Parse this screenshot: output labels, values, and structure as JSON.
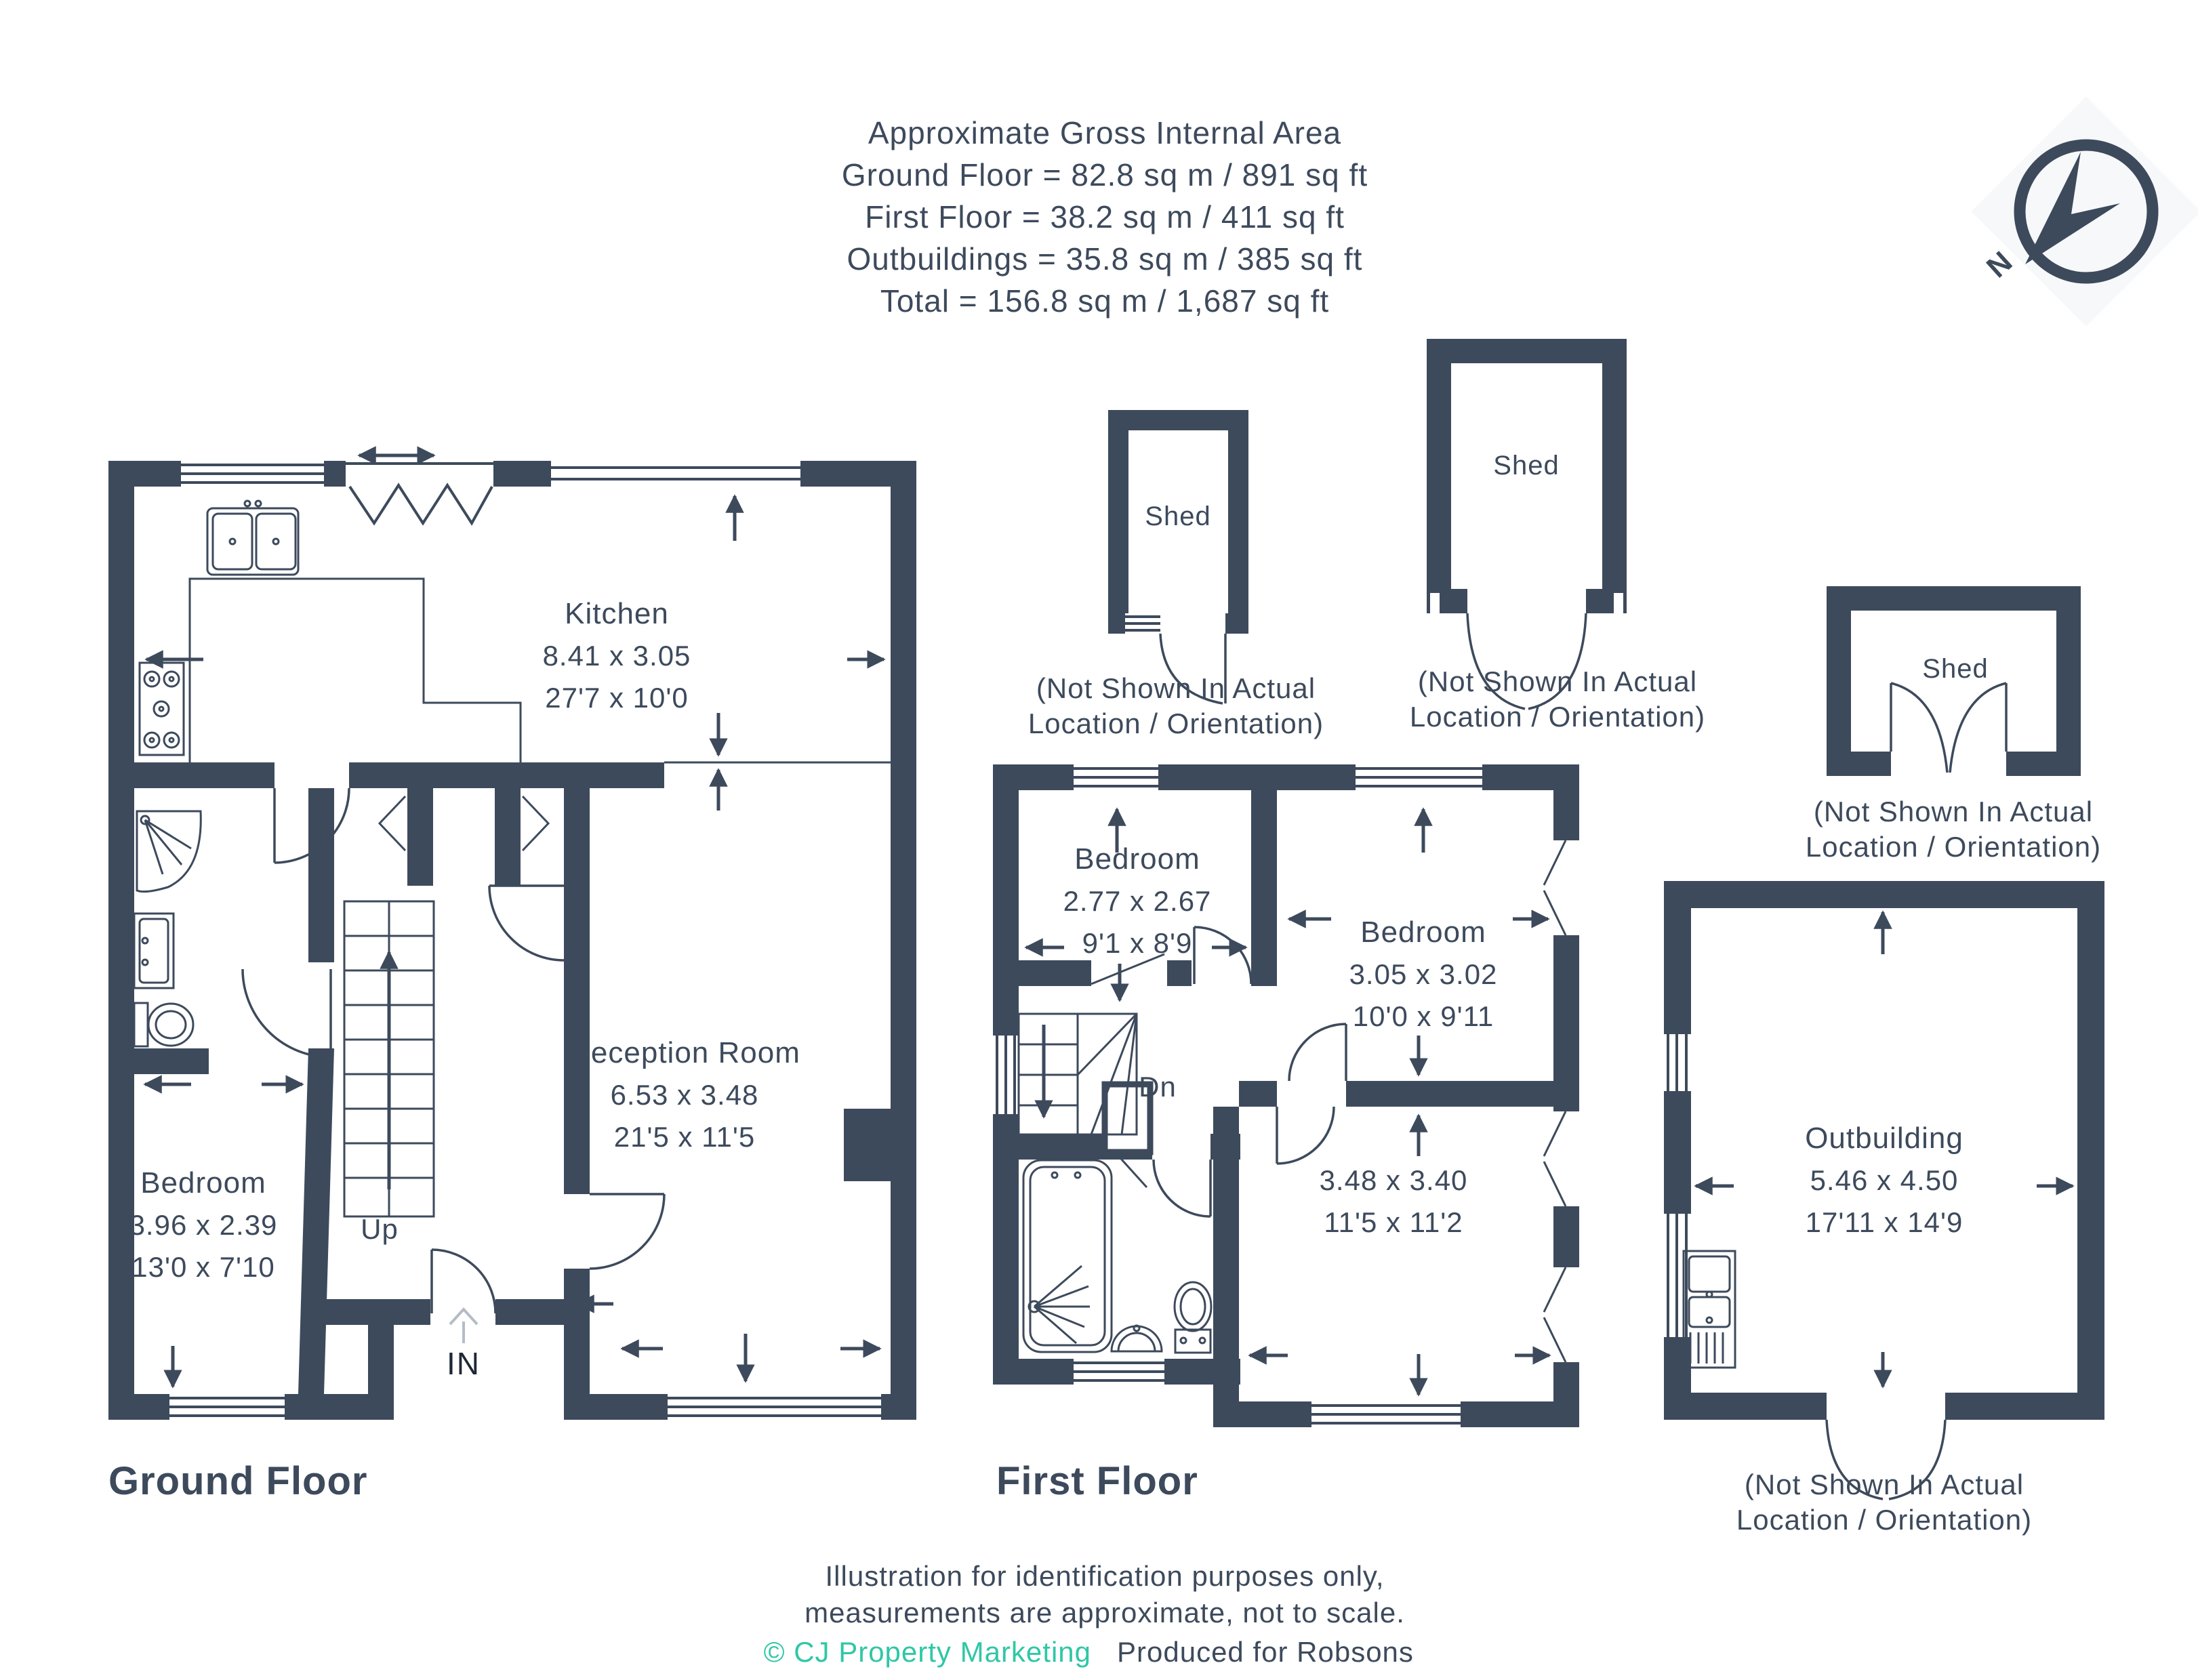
{
  "colors": {
    "wall": "#3d4a5c",
    "accent_teal": "#2fc7a6",
    "background": "#ffffff"
  },
  "header": {
    "title": "Approximate Gross Internal Area",
    "lines": [
      "Ground Floor = 82.8 sq m / 891 sq ft",
      "First Floor = 38.2 sq m / 411 sq ft",
      "Outbuildings = 35.8 sq m / 385 sq ft",
      "Total = 156.8 sq m / 1,687 sq ft"
    ]
  },
  "compass": {
    "label": "N"
  },
  "ground_floor": {
    "title": "Ground Floor",
    "kitchen": {
      "name": "Kitchen",
      "metric": "8.41 x 3.05",
      "imperial": "27'7 x 10'0"
    },
    "reception": {
      "name": "Reception Room",
      "metric": "6.53 x 3.48",
      "imperial": "21'5 x 11'5"
    },
    "bedroom": {
      "name": "Bedroom",
      "metric": "3.96 x 2.39",
      "imperial": "13'0 x 7'10"
    },
    "stairs_label": "Up",
    "entrance_label": "IN"
  },
  "first_floor": {
    "title": "First Floor",
    "bedroom_small": {
      "name": "Bedroom",
      "metric": "2.77 x 2.67",
      "imperial": "9'1 x 8'9"
    },
    "bedroom_large": {
      "name": "Bedroom",
      "metric": "3.05 x 3.02",
      "imperial": "10'0 x 9'11"
    },
    "room": {
      "metric": "3.48 x 3.40",
      "imperial": "11'5 x 11'2"
    },
    "stairs_label": "Dn"
  },
  "outbuilding": {
    "name": "Outbuilding",
    "metric": "5.46 x 4.50",
    "imperial": "17'11 x 14'9",
    "caption1": "(Not Shown In Actual",
    "caption2": "Location / Orientation)"
  },
  "sheds": [
    {
      "label": "Shed",
      "caption1": "(Not Shown In Actual",
      "caption2": "Location / Orientation)"
    },
    {
      "label": "Shed",
      "caption1": "(Not Shown In Actual",
      "caption2": "Location / Orientation)"
    },
    {
      "label": "Shed",
      "caption1": "(Not Shown In Actual",
      "caption2": "Location / Orientation)"
    }
  ],
  "footer": {
    "line1": "Illustration for identification purposes only,",
    "line2": "measurements are approximate, not to scale.",
    "copyright": "© CJ Property Marketing",
    "produced": "Produced for Robsons"
  }
}
